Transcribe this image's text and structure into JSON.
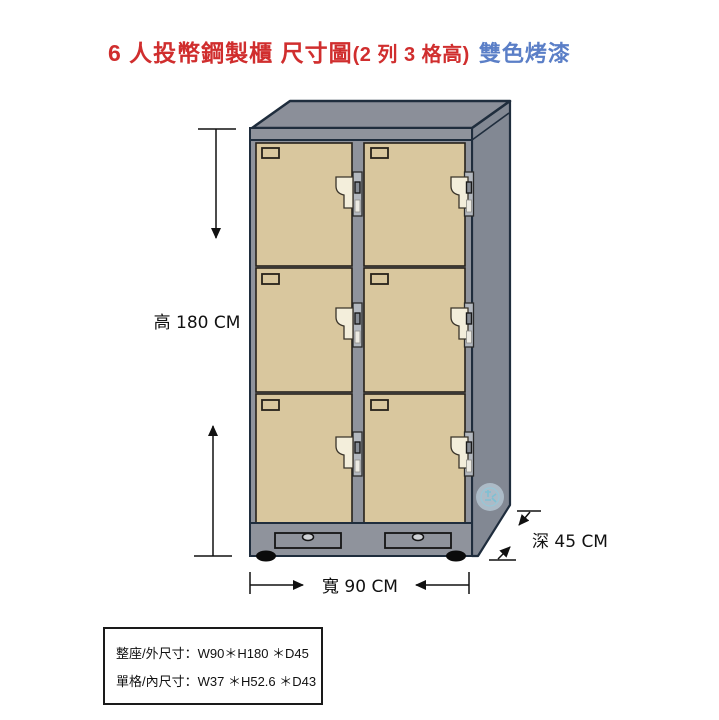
{
  "title": {
    "product": "6 人投幣鋼製櫃 尺寸圖",
    "config": "(2 列 3 格高)",
    "finish": "雙色烤漆"
  },
  "dimensions": {
    "height_label": "高 180 CM",
    "width_label": "寬 90 CM",
    "depth_label": "深 45 CM"
  },
  "spec_box": {
    "outer": "整座/外尺寸：W90＊H180 ＊D45",
    "inner": "單格/內尺寸：W37 ＊H52.6 ＊D43"
  },
  "cabinet": {
    "type": "coin-operated steel locker",
    "columns": 2,
    "rows": 3,
    "compartments": 6,
    "colors": {
      "frame": "#8f939c",
      "top": "#8b8f99",
      "side": "#828893",
      "door": "#d9c79e",
      "outline": "#1f2d3d",
      "lock": "#f3eedb",
      "title_red": "#d02e2e",
      "title_blue": "#5b7fc7"
    }
  }
}
